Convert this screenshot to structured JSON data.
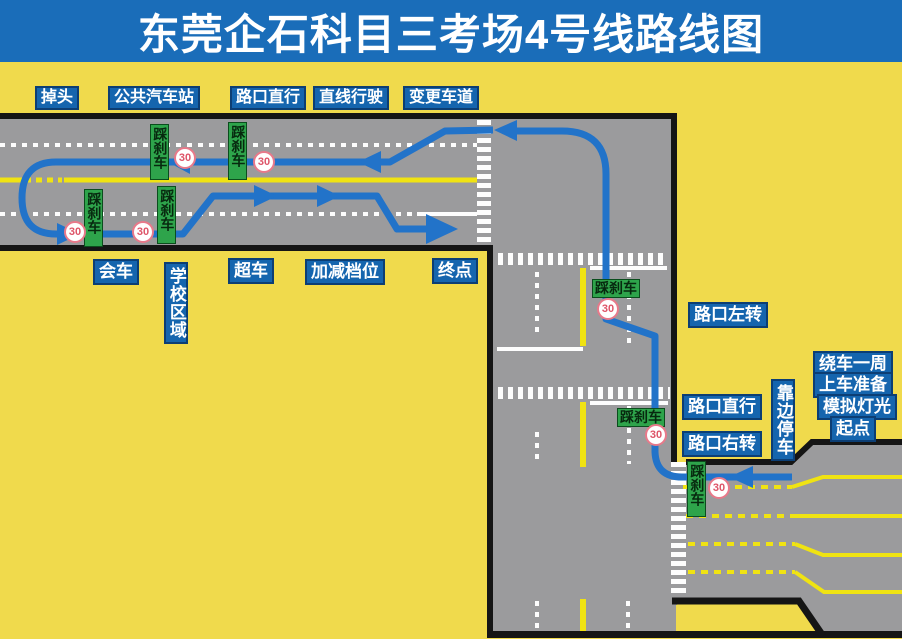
{
  "title": "东莞企石科目三考场4号线路线图",
  "top_legend": {
    "u_turn": "掉头",
    "bus_station": "公共汽车站",
    "junction_straight": "路口直行",
    "straight_driving": "直线行驶",
    "change_lane": "变更车道"
  },
  "road_labels": {
    "meeting": "会车",
    "school_zone": "学校区域",
    "overtaking": "超车",
    "gear_shift": "加减档位",
    "end_point": "终点",
    "junction_left_turn": "路口左转",
    "junction_straight": "路口直行",
    "junction_right_turn": "路口右转",
    "pull_over": "靠边停车",
    "around_vehicle": "绕车一周",
    "boarding_prep": "上车准备",
    "light_simulation": "模拟灯光",
    "start_point": "起点"
  },
  "markers": {
    "brake": "踩刹车",
    "speed_limit": "30"
  },
  "colors": {
    "background_yellow": "#F0DA4C",
    "title_bar_blue": "#1A6DB9",
    "label_blue": "#1565AE",
    "road_gray": "#9B9B9D",
    "route_blue": "#2273C9",
    "brake_green": "#2EA44B",
    "speed_ring_red": "#E8798A",
    "lane_yellow": "#F0E312"
  }
}
